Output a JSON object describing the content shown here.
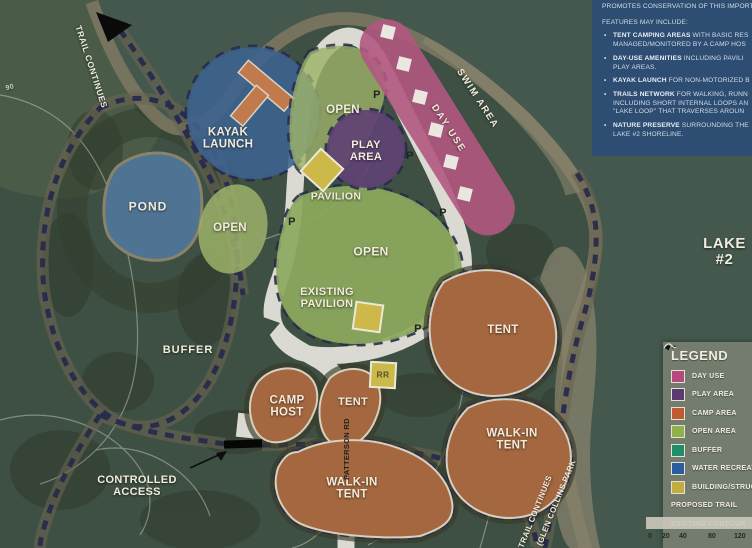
{
  "colors": {
    "land": "#3e5043",
    "field": "#4a5c48",
    "water": "#44584e",
    "beach": "#7b7762",
    "road": "#dad9d2",
    "trail": "#272b4d",
    "trail_halo": "#6b6450",
    "kayak": "#3d6390",
    "pond": "#4f7392",
    "play": "#604273",
    "day_use": "#b15680",
    "open": "#8ca95d",
    "open_light": "#9cb168",
    "camp": "#a5673f",
    "building": "#cdb94a",
    "info_bg": "#2e4d72",
    "legend_bg": "#747d6d"
  },
  "map": {
    "p_marker": "P",
    "labels": {
      "trail_continues_nw": "TRAIL CONTINUES",
      "contour_90": "90",
      "kayak_launch": "KAYAK\nLAUNCH",
      "pond": "POND",
      "open_left": "OPEN",
      "open_top": "OPEN",
      "play_area": "PLAY\nAREA",
      "pavilion": "PAVILION",
      "open_center": "OPEN",
      "existing_pavilion": "EXISTING\nPAVILION",
      "swim_area": "SWIM AREA",
      "day_use": "DAY USE",
      "lake_2": "LAKE #2",
      "buffer": "BUFFER",
      "camp_host": "CAMP\nHOST",
      "tent_mid": "TENT",
      "tent_right": "TENT",
      "walk_in_right": "WALK-IN\nTENT",
      "walk_in_bottom": "WALK-IN\nTENT",
      "rr": "RR",
      "controlled_access": "CONTROLLED\nACCESS",
      "patterson_rd": "PATTERSON RD",
      "trail_continues_se": "TRAIL CONTINUES",
      "glen_collins": "(GLEN COLLINS PARK"
    }
  },
  "info_box": {
    "rows": [
      {
        "marker": "",
        "bold": "",
        "text": "PROMOTES CONSERVATION OF THIS IMPORT"
      },
      {
        "marker": "",
        "bold": "",
        "text": "FEATURES MAY INCLUDE:"
      },
      {
        "marker": "•",
        "bold": "TENT CAMPING AREAS",
        "text": " WITH BASIC RES"
      },
      {
        "marker": "",
        "bold": "",
        "text": "MANAGED/MONITORED BY A CAMP HOS"
      },
      {
        "marker": "•",
        "bold": "DAY-USE AMENITIES",
        "text": " INCLUDING PAVILI"
      },
      {
        "marker": "",
        "bold": "",
        "text": "PLAY AREAS."
      },
      {
        "marker": "•",
        "bold": "KAYAK LAUNCH",
        "text": " FOR NON-MOTORIZED B"
      },
      {
        "marker": "•",
        "bold": "TRAILS NETWORK",
        "text": " FOR WALKING, RUNN"
      },
      {
        "marker": "",
        "bold": "",
        "text": "INCLUDING SHORT INTERNAL LOOPS AN"
      },
      {
        "marker": "",
        "bold": "",
        "text": "\"LAKE LOOP\" THAT TRAVERSES AROUN"
      },
      {
        "marker": "•",
        "bold": "NATURE PRESERVE",
        "text": " SURROUNDING THE"
      },
      {
        "marker": "",
        "bold": "",
        "text": "LAKE #2 SHORELINE."
      }
    ]
  },
  "legend": {
    "title": "LEGEND",
    "items": [
      {
        "label": "DAY USE",
        "color": "#b5497e"
      },
      {
        "label": "PLAY AREA",
        "color": "#5d3a6f"
      },
      {
        "label": "CAMP AREA",
        "color": "#c05a32"
      },
      {
        "label": "OPEN AREA",
        "color": "#8fb04b"
      },
      {
        "label": "BUFFER",
        "color": "#1d8e67"
      },
      {
        "label": "WATER RECREATION",
        "color": "#2b5c9d"
      },
      {
        "label": "BUILDING/STRUCTURE",
        "color": "#c4ad3e"
      }
    ],
    "trail_label": "PROPOSED TRAIL",
    "contour_label": "EXISTING CONTOUR"
  },
  "scale_bar": {
    "ticks": [
      "0",
      "20",
      "40",
      "80",
      "120"
    ]
  }
}
